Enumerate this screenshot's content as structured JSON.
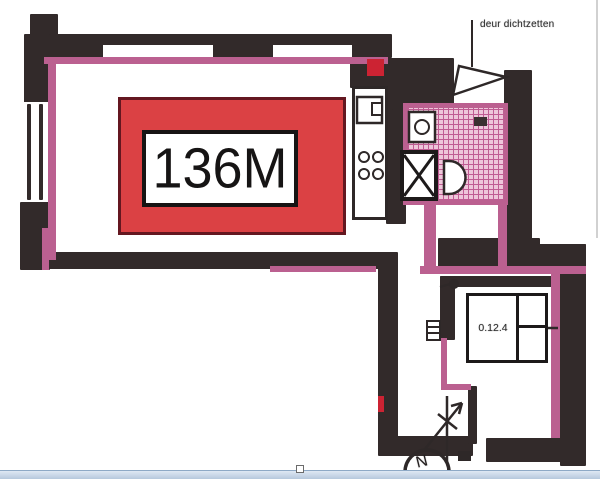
{
  "plan": {
    "highlight_label": "136M",
    "room_number": "0.12.4",
    "door_note": "deur dichtzetten",
    "north_label": "N"
  },
  "icons": {
    "north_indicator": "circle with letter N and arrow",
    "door_swing": "triangle swing lines",
    "shower_tray": "square with X cross",
    "stove": "four burner circles",
    "sink": "square basin with tap box",
    "toilet": "D-shaped bowl",
    "washbasin": "box with circle",
    "radiator": "small lined box",
    "resize_handle": "small white square"
  },
  "colors": {
    "wall": "#322a2a",
    "pink": "#bb6090",
    "tile_fill": "#eec6da",
    "tile_line": "#c05c93",
    "red_fill": "#db4144",
    "red_border": "#641720",
    "red_accent": "#cc2333",
    "line": "#2e2828",
    "bar_fill_top": "#dfe8f3",
    "bar_fill_bottom": "#b6c8dd",
    "bar_border": "#8ea9c6",
    "page_edge": "#b9b9b9"
  }
}
